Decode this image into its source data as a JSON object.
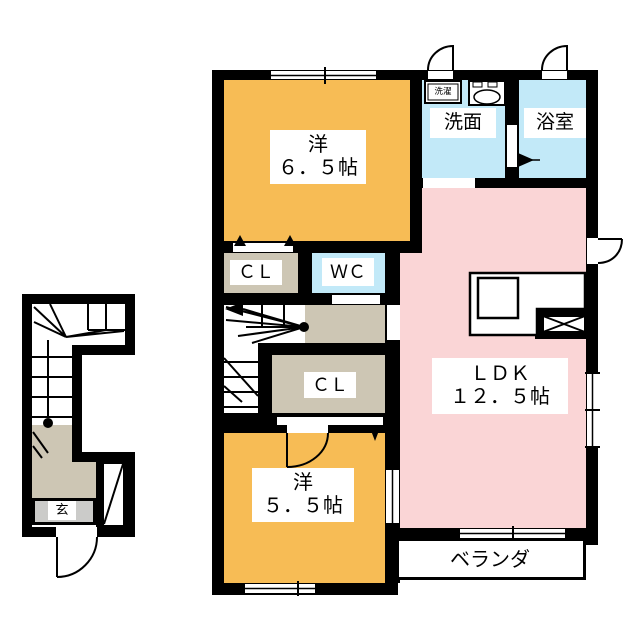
{
  "plan": {
    "title": "2F floor plan",
    "rooms": {
      "western1": {
        "name": "洋",
        "size": "６．５帖"
      },
      "western2": {
        "name": "洋",
        "size": "５．５帖"
      },
      "ldk": {
        "name": "ＬＤＫ",
        "size": "１２．５帖"
      },
      "washroom": {
        "label": "洗面"
      },
      "bathroom": {
        "label": "浴室"
      },
      "wc": {
        "label": "ＷＣ"
      },
      "closet1": {
        "label": "ＣＬ"
      },
      "closet2": {
        "label": "ＣＬ"
      },
      "veranda": {
        "label": "ベランダ"
      },
      "entrance": {
        "label": "玄"
      },
      "washer": {
        "label": "洗濯"
      }
    },
    "colors": {
      "room_orange": "#F7BC55",
      "room_pink": "#FAD5D6",
      "room_cyan": "#C2E9F8",
      "floor_beige": "#CDC6B4",
      "floor_gray": "#CBCBC9",
      "wall": "#000000",
      "line": "#000000"
    }
  }
}
